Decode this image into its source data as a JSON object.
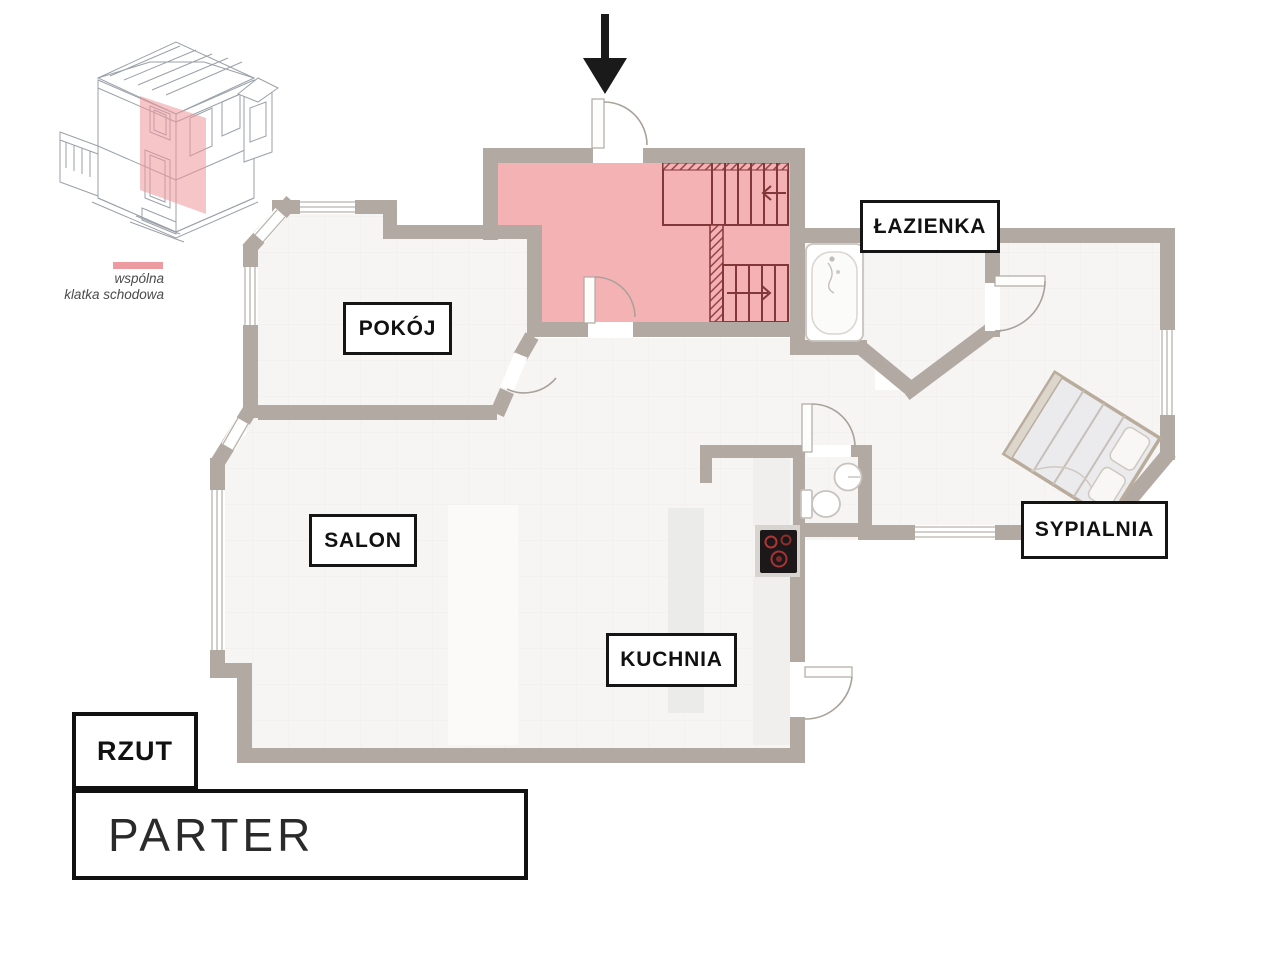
{
  "inset": {
    "legend_line1": "wspólna",
    "legend_line2": "klatka schodowa",
    "swatch_color": "#ec9ba1"
  },
  "rooms": {
    "pokoj": "POKÓJ",
    "salon": "SALON",
    "kuchnia": "KUCHNIA",
    "lazienka": "ŁAZIENKA",
    "sypialnia": "SYPIALNIA"
  },
  "titleblock": {
    "tag": "RZUT",
    "floor": "PARTER"
  },
  "icons": [
    "entrance-arrow-icon",
    "staircase-icon",
    "bathtub-icon",
    "toilet-icon",
    "sink-icon",
    "stove-icon",
    "bed-icon",
    "door-swing-icon",
    "house-3d-icon"
  ],
  "colors": {
    "highlight_pink": "#f5b2b5",
    "stairs_line": "#823838",
    "wall": "#b2a9a2",
    "floor": "#f6f5f3"
  }
}
